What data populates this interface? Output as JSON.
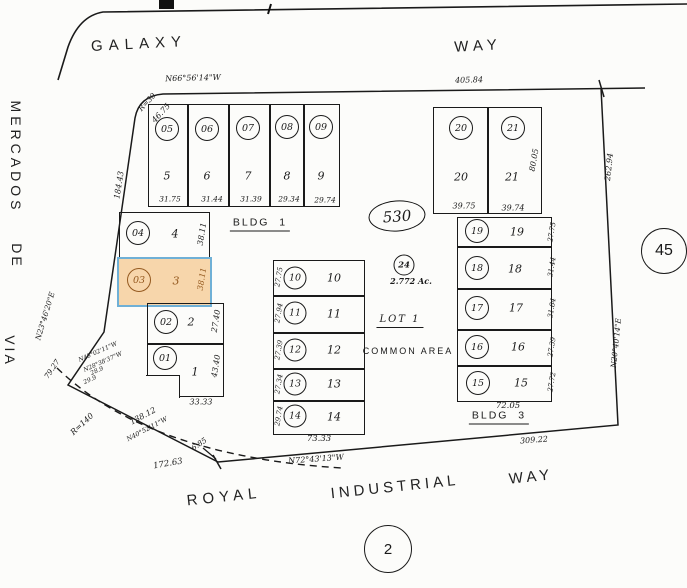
{
  "streets": {
    "galaxy": "GALAXY",
    "galaxy_way": "WAY",
    "via": "VIA",
    "de": "DE",
    "mercados": "MERCADOS",
    "royal": "ROYAL",
    "industrial": "INDUSTRIAL",
    "royal_way": "WAY"
  },
  "boundary": {
    "north_bearing": "N66°56'14\"W",
    "north_dist": "405.84",
    "west_dist": "184.43",
    "west_bearing": "N23°46'20\"E",
    "nw_radius": "R=30",
    "nw_arc": "46.75",
    "east_dist": "262.94",
    "east_bearing": "N20°40'14\"E",
    "south_bearing": "N72°43'13\"W",
    "south_dist": "309.22",
    "sw_radius": "R=140",
    "sw_arc": "172.63",
    "sw_seg1": "79.27",
    "sw_seg2": "138.12",
    "sw_seg2_bearing": "N40°52'11\"W",
    "sw_seg3": "6.85",
    "sw_tiny": [
      "N48°02'11\"W",
      "N28°38'37\"W",
      "28.9",
      "29.9"
    ]
  },
  "refs": {
    "book": "530",
    "page": "2",
    "adjacent": "45"
  },
  "common_area": {
    "tag": "24",
    "acreage": "2.772 Ac.",
    "lot": "LOT 1",
    "label": "COMMON AREA"
  },
  "buildings": {
    "bldg1": "BLDG  1",
    "bldg3": "BLDG  3"
  },
  "highlight": {
    "parcel": "03",
    "fill": "#f7d6ab",
    "border": "#6fb0d6",
    "text": "#94591f"
  },
  "blocks": {
    "stair": {
      "lots": [
        {
          "tag": "04",
          "num": "4",
          "side": "38.11"
        },
        {
          "tag": "03",
          "num": "3",
          "side": "38.11"
        },
        {
          "tag": "02",
          "num": "2",
          "side": "27.40"
        },
        {
          "tag": "01",
          "num": "1",
          "side": "43.40"
        }
      ],
      "bottom": "33.33"
    },
    "a": {
      "lots": [
        {
          "tag": "05",
          "num": "5",
          "dim": "31.75"
        },
        {
          "tag": "06",
          "num": "6",
          "dim": "31.44"
        },
        {
          "tag": "07",
          "num": "7",
          "dim": "31.39"
        },
        {
          "tag": "08",
          "num": "8",
          "dim": "29.34"
        },
        {
          "tag": "09",
          "num": "9",
          "dim": "29.74"
        }
      ]
    },
    "b": {
      "lots": [
        {
          "tag": "10",
          "num": "10",
          "dim": "27.75"
        },
        {
          "tag": "11",
          "num": "11",
          "dim": "27.94"
        },
        {
          "tag": "12",
          "num": "12",
          "dim": "27.39"
        },
        {
          "tag": "13",
          "num": "13",
          "dim": "27.34"
        },
        {
          "tag": "14",
          "num": "14",
          "dim": "29.74"
        }
      ],
      "bottom": "73.33"
    },
    "c": {
      "lots": [
        {
          "tag": "19",
          "num": "19",
          "dim": "27.75"
        },
        {
          "tag": "18",
          "num": "18",
          "dim": "31.44"
        },
        {
          "tag": "17",
          "num": "17",
          "dim": "31.84"
        },
        {
          "tag": "16",
          "num": "16",
          "dim": "27.39"
        },
        {
          "tag": "15",
          "num": "15",
          "dim": "27.72"
        }
      ],
      "bottom": "72.05"
    },
    "d": {
      "lots": [
        {
          "tag": "20",
          "num": "20",
          "dim": "39.75"
        },
        {
          "tag": "21",
          "num": "21",
          "dim": "39.74"
        }
      ],
      "side": "80.05"
    }
  }
}
